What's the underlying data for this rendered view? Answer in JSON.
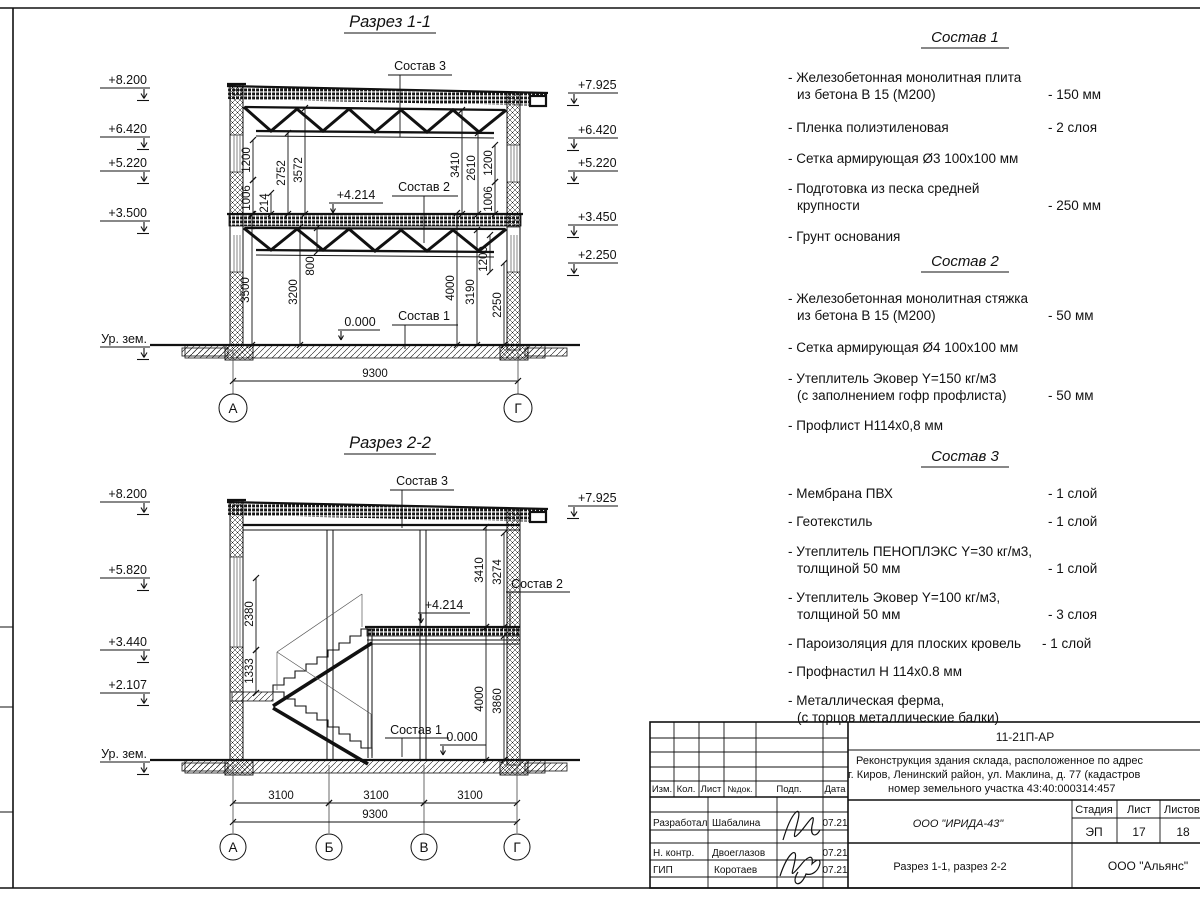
{
  "s1": {
    "title": "Разрез 1-1",
    "elev": {
      "e0": "+8.200",
      "e1": "+6.420",
      "e2": "+5.220",
      "e3": "+3.500",
      "ground": "Ур. зем.",
      "r0": "+7.925",
      "r1": "+6.420",
      "r2": "+5.220",
      "r3": "+3.450",
      "r4": "+2.250"
    },
    "lbl": {
      "s3": "Состав 3",
      "s2": "Состав 2",
      "s1": "Состав 1",
      "mid": "+4.214",
      "zero": "0.000"
    },
    "dim": {
      "d1200a": "1200",
      "d1006a": "1006",
      "d214": "214",
      "d2752": "2752",
      "d3572": "3572",
      "d3410": "3410",
      "d2610": "2610",
      "d1200b": "1200",
      "d1006b": "1006",
      "d3500": "3500",
      "d3200": "3200",
      "d800": "800",
      "d4000": "4000",
      "d3190": "3190",
      "d1200c": "1200",
      "d2250": "2250",
      "total": "9300"
    },
    "ax": {
      "a": "А",
      "g": "Г"
    }
  },
  "s2": {
    "title": "Разрез 2-2",
    "elev": {
      "e0": "+8.200",
      "e1": "+5.820",
      "e2": "+3.440",
      "e3": "+2.107",
      "ground": "Ур. зем.",
      "r0": "+7.925"
    },
    "lbl": {
      "s3": "Состав 3",
      "s2": "Состав 2",
      "s1": "Состав 1",
      "mid": "+4.214",
      "zero": "0.000"
    },
    "dim": {
      "d2380": "2380",
      "d1333": "1333",
      "d3410": "3410",
      "d3274": "3274",
      "d4000": "4000",
      "d3860": "3860",
      "b0": "3100",
      "b1": "3100",
      "b2": "3100",
      "total": "9300"
    },
    "ax": {
      "a": "А",
      "b": "Б",
      "v": "В",
      "g": "Г"
    }
  },
  "comp": [
    {
      "title": "Состав 1",
      "lines": [
        {
          "t": "- Железобетонная  монолитная плита"
        },
        {
          "t": "из бетона В 15 (М200)",
          "v": "- 150 мм"
        },
        {
          "t": "- Пленка полиэтиленовая",
          "v": "-  2 слоя"
        },
        {
          "t": "- Сетка армирующая Ø3 100х100 мм"
        },
        {
          "t": "- Подготовка из песка средней"
        },
        {
          "t": "крупности",
          "v": "- 250 мм"
        },
        {
          "t": "- Грунт основания"
        }
      ]
    },
    {
      "title": "Состав 2",
      "lines": [
        {
          "t": "- Железобетонная  монолитная стяжка"
        },
        {
          "t": "из бетона В 15 (М200)",
          "v": "- 50 мм"
        },
        {
          "t": "- Сетка армирующая Ø4 100х100 мм"
        },
        {
          "t": "- Утеплитель Эковер Y=150 кг/м3"
        },
        {
          "t": "(с заполнением гофр профлиста)",
          "v": "- 50 мм"
        },
        {
          "t": "- Профлист Н114х0,8 мм"
        }
      ]
    },
    {
      "title": "Состав 3",
      "lines": [
        {
          "t": "- Мембрана ПВХ",
          "v": "- 1 слой"
        },
        {
          "t": "- Геотекстиль",
          "v": "- 1 слой"
        },
        {
          "t": "- Утеплитель ПЕНОПЛЭКС Y=30 кг/м3,"
        },
        {
          "t": "толщиной 50 мм",
          "v": "- 1 слой"
        },
        {
          "t": "- Утеплитель Эковер Y=100 кг/м3,"
        },
        {
          "t": "толщиной 50 мм",
          "v": "- 3 слоя"
        },
        {
          "t": "- Пароизоляция для плоских кровель",
          "v": "- 1 слой"
        },
        {
          "t": "- Профнастил Н 114х0.8 мм"
        },
        {
          "t": "- Металлическая ферма,"
        },
        {
          "t": "(с торцов металлические балки)"
        }
      ]
    }
  ],
  "tb": {
    "code": "11-21П-АР",
    "addr1": "Реконструкция здания склада, расположенное по адрес",
    "addr2": "г. Киров, Ленинский район, ул. Маклина, д. 77 (кадастров",
    "addr3": "номер земельного участка 43:40:000314:457",
    "org": "ООО \"ИРИДА-43\"",
    "stage_h": "Стадия",
    "sheet_h": "Лист",
    "sheets_h": "Листов",
    "stage": "ЭП",
    "sheet": "17",
    "sheets": "18",
    "sheet_title": "Разрез 1-1, разрез 2-2",
    "org2": "ООО \"Альянс\"",
    "cols": {
      "izm": "Изм.",
      "kol": "Кол.",
      "list": "Лист",
      "ndoc": "№док.",
      "podp": "Подп.",
      "data": "Дата"
    },
    "rows": [
      {
        "role": "Разработал",
        "name": "Шабалина",
        "date": "07.21"
      },
      {
        "role": "Н. контр.",
        "name": "Двоеглазов",
        "date": "07.21"
      },
      {
        "role": "ГИП",
        "name": "Коротаев",
        "date": "07.21"
      }
    ]
  }
}
